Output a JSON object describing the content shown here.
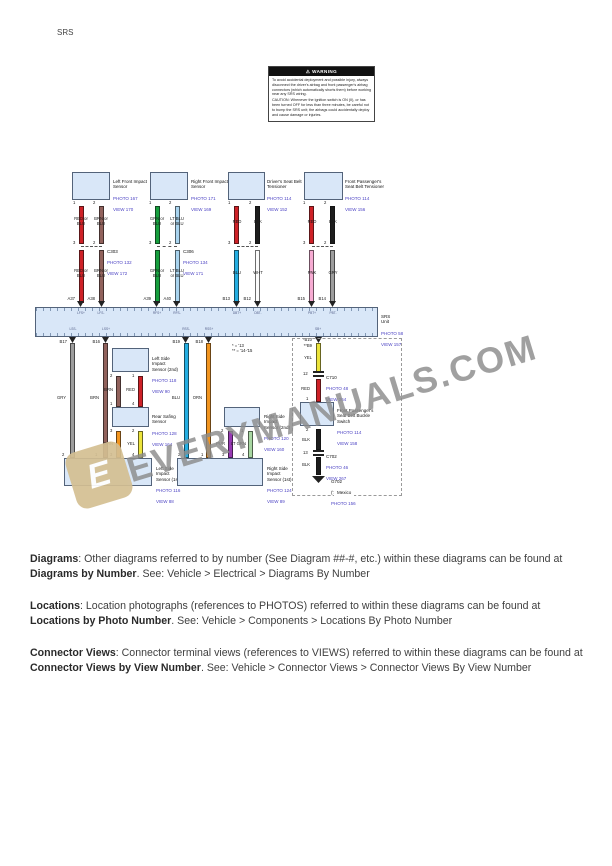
{
  "page": {
    "header_code": "SRS"
  },
  "warning": {
    "title": "WARNING",
    "para1": "To avoid accidental deployment and possible injury, always disconnect the driver's airbag and front passenger's airbag connectors (which automatically shorts them) before working near any SRS wiring.",
    "para2": "CAUTION: Whenever the ignition switch is ON (II), or has been turned OFF for less than three minutes, be careful not to bump the SRS unit; the airbags could accidentally deploy and cause damage or injuries."
  },
  "colors": {
    "red": "#ce2127",
    "brown": "#91625c",
    "green": "#169f3d",
    "ltblue": "#a9d4ef",
    "black": "#1d1d1d",
    "blue": "#24aee2",
    "white": "#fbfbfb",
    "pink": "#f6abd2",
    "gray": "#9d9d9d",
    "orange": "#f2951f",
    "yellow": "#ece43b",
    "purple": "#9739b3",
    "ltgreen": "#a8d7a2",
    "box_fill": "#d9e7f8",
    "ref_text": "#4d44c4",
    "watermark": "#8c8c8c",
    "logo": "#d4bf92"
  },
  "diagram": {
    "top_connectors": [
      {
        "name": "Left Front Impact\nSensor",
        "photo": "PHOTO 167",
        "view": "VIEW 170",
        "pin1": "1",
        "pin2": "2",
        "jpin1": "3",
        "jpin2": "2",
        "jname": "C303",
        "jphoto": "PHOTO 132",
        "jview": "VIEW 172",
        "w1u": "RED or\nBLU",
        "w2u": "BRN or\nBLU",
        "w1l": "RED or\nBLU",
        "w2l": "BRN or\nBLU",
        "a1": "A37",
        "a2": "A38"
      },
      {
        "name": "Right Front Impact\nSensor",
        "photo": "PHOTO 171",
        "view": "VIEW 169",
        "pin1": "1",
        "pin2": "2",
        "jpin1": "3",
        "jpin2": "2",
        "jname": "C306",
        "jphoto": "PHOTO 134",
        "jview": "VIEW 171",
        "w1u": "GRN or\nBLU",
        "w2u": "LT BLU\nor BLU",
        "w1l": "GRN or\nBLU",
        "w2l": "LT BLU\nor BLU",
        "a1": "A39",
        "a2": "A40"
      },
      {
        "name": "Driver's Seat Belt\nTensioner",
        "photo": "PHOTO 114",
        "view": "VIEW 152",
        "pin1": "1",
        "pin2": "2",
        "jpin1": "3",
        "jpin2": "2",
        "w1u": "RED",
        "w2u": "BLK",
        "w1l": "BLU",
        "w2l": "WHT",
        "a1": "B13",
        "a2": "B12"
      },
      {
        "name": "Front Passenger's\nSeat Belt Tensioner",
        "photo": "PHOTO 114",
        "view": "VIEW 156",
        "pin1": "1",
        "pin2": "2",
        "jpin1": "3",
        "jpin2": "2",
        "w1u": "RED",
        "w2u": "BLK",
        "w1l": "PNK",
        "w2l": "GRY",
        "a1": "B15",
        "a2": "B14"
      }
    ],
    "srs_unit": {
      "name": "SRS\nUnit",
      "photo": "PHOTO 58",
      "view": "VIEW 157",
      "top_labels": [
        "LFS+",
        "LFS-",
        "RFS+",
        "RFS-",
        "DBT+",
        "DBT-",
        "PBT+",
        "PBT-"
      ],
      "bottom_labels": [
        "LSS-",
        "LSS+",
        "RSS-",
        "RSS+",
        "SB+"
      ]
    },
    "lower": {
      "pins": {
        "b17": "B17",
        "b16": "B16",
        "b19": "B19",
        "b18": "B18",
        "sb1": "*B10",
        "sb2": "**B9"
      },
      "wire_labels": {
        "gry": "GRY",
        "brn": "BRN",
        "blu": "BLU",
        "orn": "ORN",
        "yel": "YEL",
        "red": "RED",
        "blk1": "BLK",
        "blk2": "BLK",
        "chain_brn": "BRN",
        "chain_red": "RED",
        "chain_orn": "ORN",
        "chain_yel": "YEL",
        "pur": "PUR",
        "ltgrn": "LT GRN"
      },
      "ls2": {
        "name": "Left Side\nImpact\nSensor (2nd)",
        "photo": "PHOTO 118",
        "view": "VIEW 90",
        "pb1": "2",
        "pb2": "1"
      },
      "rear_safing": {
        "name": "Rear Safing\nSensor",
        "photo": "PHOTO 128",
        "view": "VIEW 164",
        "pt1": "1",
        "pt2": "4",
        "pb1": "3",
        "pb2": "2"
      },
      "ls1": {
        "name": "Left Side\nImpact\nSensor (1st)",
        "photo": "PHOTO 116",
        "view": "VIEW 88",
        "p1": "2",
        "p2": "1",
        "p3": "3",
        "p4": "4"
      },
      "rs2": {
        "name": "Right Side\nImpact\nSensor (2nd)",
        "photo": "PHOTO 120",
        "view": "VIEW 160",
        "pb1": "2",
        "pb2": "1"
      },
      "rs1": {
        "name": "Right Side\nImpact\nSensor (1st)",
        "photo": "PHOTO 124",
        "view": "VIEW 89",
        "p1": "2",
        "p2": "1",
        "p3": "3",
        "p4": "4"
      },
      "buckle": {
        "name": "Front Passenger's\nSeat Belt Buckle\nSwitch",
        "photo": "PHOTO 114",
        "view": "VIEW 158",
        "pt": "1",
        "pb": "2"
      },
      "c710": {
        "pin": "12",
        "name": "C710",
        "photo": "PHOTO 48",
        "view": "VIEW 264"
      },
      "c702": {
        "pin": "13",
        "name": "C702",
        "photo": "PHOTO 46",
        "view": "VIEW 267"
      },
      "g702": {
        "name": "G702",
        "years": "('14-'15)",
        "photo": "PHOTO 156"
      },
      "region": "Mexico",
      "footnotes": "* = '13\n** = '14-'15"
    }
  },
  "watermark": {
    "text": "EVERYMANUALS.COM",
    "logo_glyph": "E"
  },
  "footer": {
    "p1_b1": "Diagrams",
    "p1_t1": ": Other diagrams referred to by number (See Diagram ##-#, etc.) within these diagrams can be found at ",
    "p1_b2": "Diagrams by Number",
    "p1_t2": ". See: Vehicle > Electrical > Diagrams By Number",
    "p2_b1": "Locations",
    "p2_t1": ": Location photographs (references to PHOTOS) referred to within these diagrams can be found at ",
    "p2_b2": "Locations by Photo Number",
    "p2_t2": ". See: Vehicle > Components > Locations By Photo Number",
    "p3_b1": "Connector Views",
    "p3_t1": ": Connector terminal views (references to VIEWS) referred to within these diagrams can be found at ",
    "p3_b2": "Connector Views by View Number",
    "p3_t2": ". See: Vehicle > Connector Views > Connector Views By View Number"
  }
}
